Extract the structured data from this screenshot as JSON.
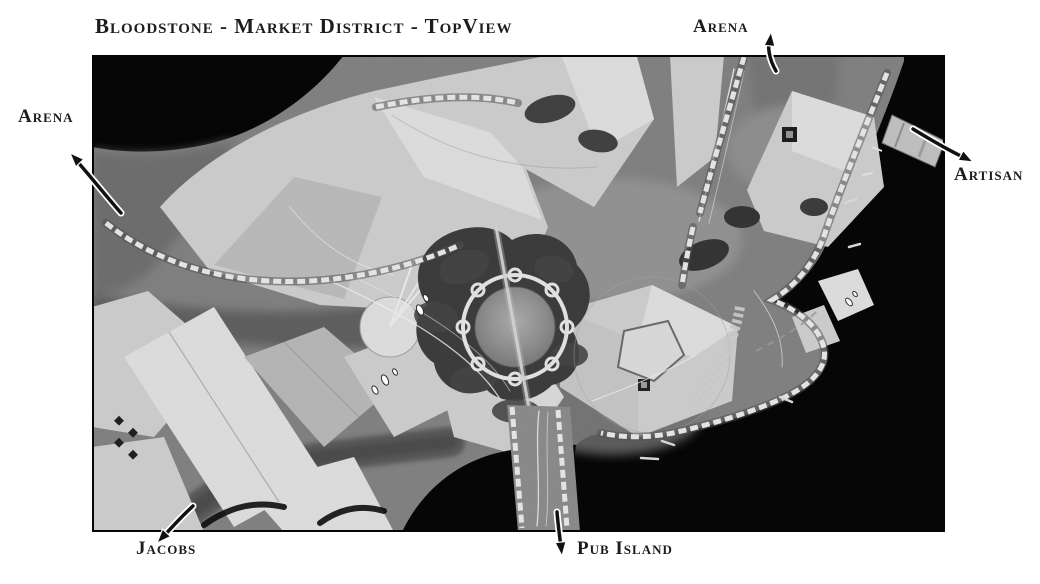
{
  "title": "Bloodstone - Market District - TopView",
  "map": {
    "alt": "Grayscale top-down 3D render of the Bloodstone Market District",
    "labels": {
      "arena_left": "Arena",
      "arena_top": "Arena",
      "artisan": "Artisan",
      "jacobs": "Jacobs",
      "pub_island": "Pub Island"
    }
  },
  "palette": {
    "page_bg": "#ffffff",
    "label_text": "#1c1c1c",
    "void_black": "#050505",
    "terrain_mid": "#7d7d7d",
    "terrain_dark": "#6a6a6a",
    "street_dark": "#555555",
    "building_light": "#dadada",
    "building_base": "#c9c9c9",
    "building_mid": "#b2b2b2",
    "foliage_dark": "#3a3a3a",
    "wall_light": "#e3e3e3",
    "road_line": "#eeeeee",
    "arrow_color": "#111111"
  }
}
